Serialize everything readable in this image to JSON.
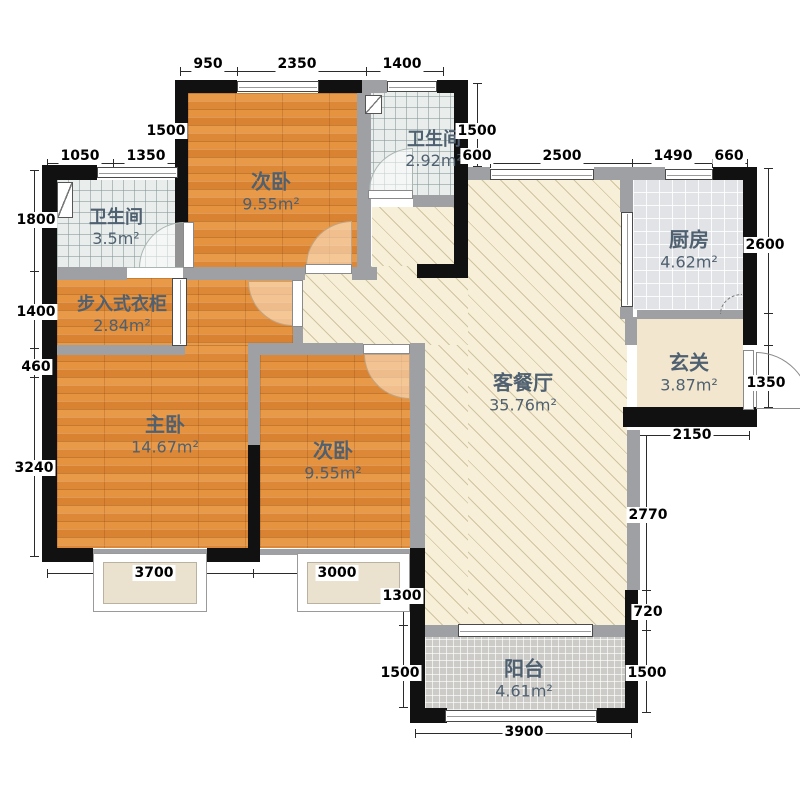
{
  "colors": {
    "wall": "#111111",
    "wall_light": "#9fa0a4",
    "wood": "#e0913f",
    "living_floor": "#f7efd8",
    "bath_tile": "#e9edec",
    "kitchen_tile": "#e1e3e6",
    "balcony_tile": "#cccbc7",
    "label_text": "#4f6070",
    "dim_text": "#000000"
  },
  "plan": {
    "rooms": [
      {
        "id": "bedroom-top",
        "name": "次卧",
        "area": "9.55m²"
      },
      {
        "id": "bath-top",
        "name": "卫生间",
        "area": "2.92m²"
      },
      {
        "id": "bath-left",
        "name": "卫生间",
        "area": "3.5m²"
      },
      {
        "id": "closet",
        "name": "步入式衣柜",
        "area": "2.84m²"
      },
      {
        "id": "master",
        "name": "主卧",
        "area": "14.67m²"
      },
      {
        "id": "bedroom-bottom",
        "name": "次卧",
        "area": "9.55m²"
      },
      {
        "id": "living",
        "name": "客餐厅",
        "area": "35.76m²"
      },
      {
        "id": "kitchen",
        "name": "厨房",
        "area": "4.62m²"
      },
      {
        "id": "foyer",
        "name": "玄关",
        "area": "3.87m²"
      },
      {
        "id": "balcony",
        "name": "阳台",
        "area": "4.61m²"
      }
    ],
    "dims": [
      "950",
      "2350",
      "1400",
      "1500",
      "1050",
      "1350",
      "1800",
      "1400",
      "460",
      "3240",
      "1500",
      "600",
      "2500",
      "1490",
      "660",
      "2600",
      "1350",
      "2150",
      "2770",
      "720",
      "1500",
      "3700",
      "3000",
      "1300",
      "1500",
      "3900"
    ]
  }
}
